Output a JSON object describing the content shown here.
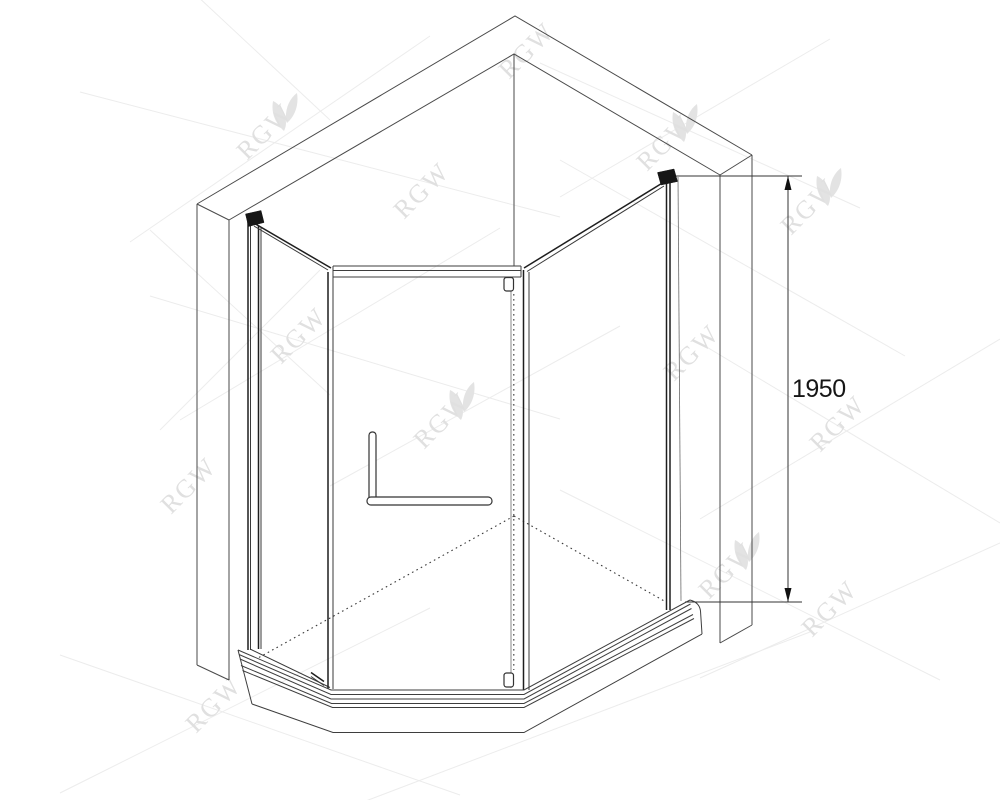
{
  "page": {
    "background": "#ffffff",
    "width": 1000,
    "height": 800
  },
  "drawing": {
    "title": "Neo-angle corner shower enclosure - technical isometric line drawing",
    "dimension": {
      "value": "1950"
    },
    "watermark": {
      "text": "RGW",
      "color": "#e0e0e0",
      "logo_icon": "rgw-leaf-icon"
    },
    "colors": {
      "line": "#4a4a4a",
      "glass_edge": "#1e1e1e",
      "hidden_edge_dash": "#3a3a3a",
      "dimension_text": "#161616",
      "watermark": "#e0e0e0",
      "background": "#ffffff"
    }
  }
}
